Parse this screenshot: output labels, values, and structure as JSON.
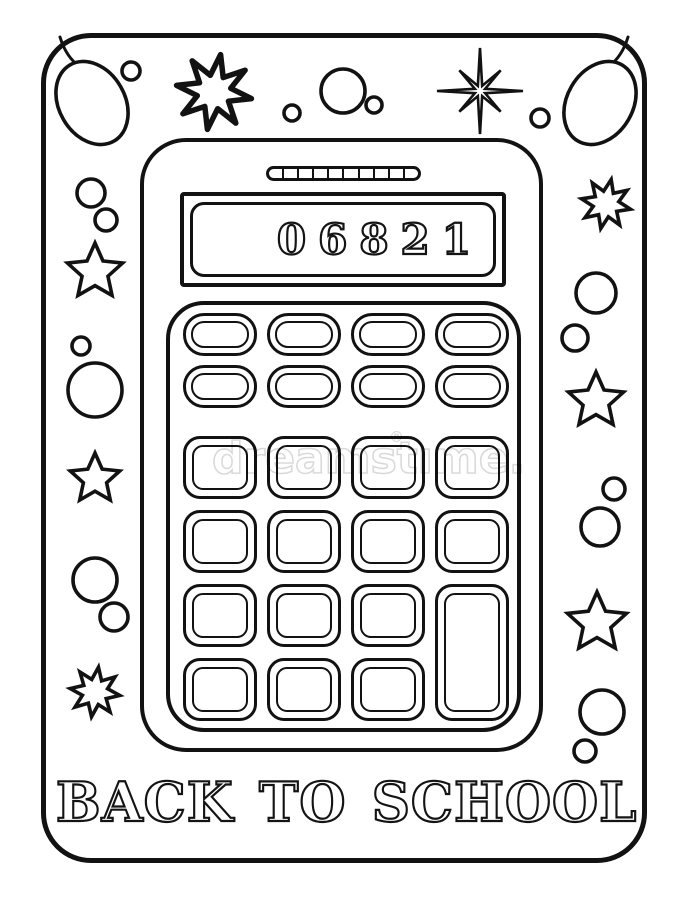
{
  "page": {
    "background_color": "#ffffff",
    "line_color": "#121212",
    "style": "black-and-white coloring page line art"
  },
  "poster": {
    "title": "BACK TO SCHOOL"
  },
  "calculator": {
    "display_value": "06821",
    "solar_panel_segments": 10,
    "keypad": {
      "small_pill_buttons": 8,
      "square_buttons": 14,
      "tall_buttons": 1,
      "total_buttons": 23,
      "buttons_unlabeled": true
    }
  },
  "watermark": {
    "text": "dreamstime",
    "display_text": "dreamstıme.",
    "registered_mark": "®",
    "color": "rgba(0,0,0,0.15)"
  },
  "decorations": {
    "icons": [
      "balloon-egg-icon",
      "splat-star-icon",
      "sparkle-star-icon",
      "five-point-star-icon",
      "eight-point-burst-icon",
      "circle-dot-icon"
    ]
  }
}
